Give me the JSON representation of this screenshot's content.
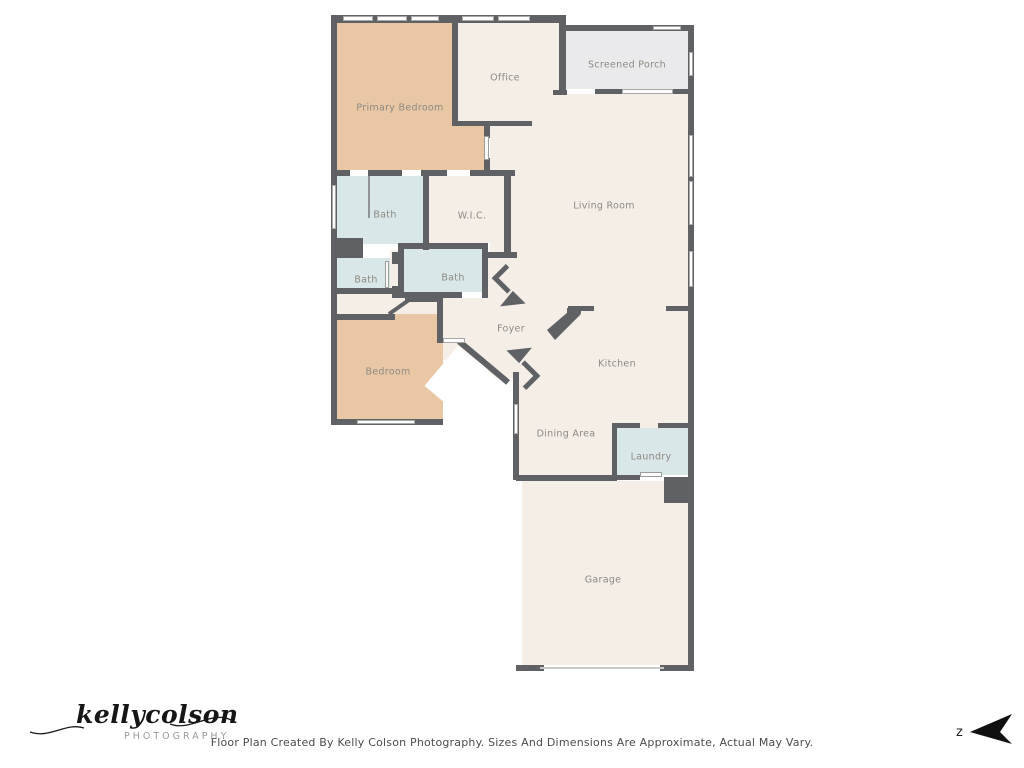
{
  "rooms": {
    "primary_bedroom": "Primary Bedroom",
    "office": "Office",
    "screened_porch": "Screened Porch",
    "living_room": "Living Room",
    "bath_primary": "Bath",
    "wic": "W.I.C.",
    "bath_hall": "Bath",
    "bath_middle": "Bath",
    "bedroom": "Bedroom",
    "foyer": "Foyer",
    "kitchen": "Kitchen",
    "dining_area": "Dining Area",
    "laundry": "Laundry",
    "garage": "Garage"
  },
  "footer": {
    "caption": "Floor Plan Created By Kelly Colson Photography. Sizes And Dimensions Are Approximate, Actual May Vary.",
    "logo_script": "kellycolson",
    "logo_sub": "PHOTOGRAPHY",
    "compass_letter": "z"
  },
  "colors": {
    "wall": "#5f6165",
    "bedroom_fill": "#eac7a4",
    "common_fill": "#f4eee6",
    "bath_fill": "#d9e7e8",
    "porch_fill": "#eaeaec",
    "label_text": "#8b8a84"
  }
}
